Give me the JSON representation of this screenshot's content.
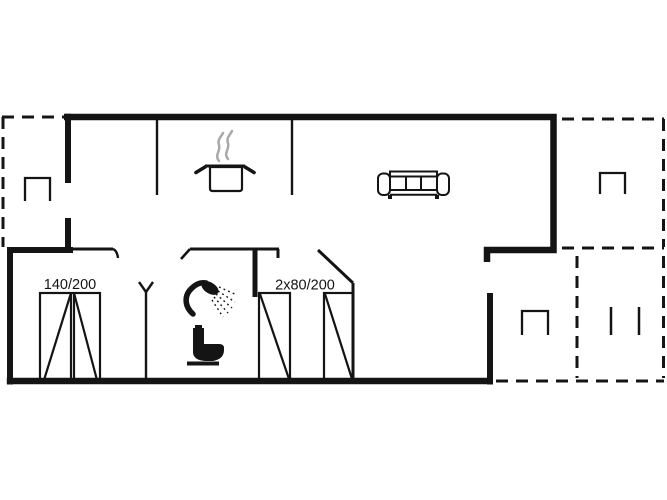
{
  "floor_plan": {
    "colors": {
      "line": "#141414",
      "steam": "#a9a9a9",
      "background": "#ffffff"
    },
    "labels": {
      "double_bed": "140/200",
      "twin_beds": "2x80/200"
    },
    "icons": {
      "kitchen": "cooking-pot-icon",
      "living_room": "sofa-icon",
      "bathroom": [
        "shower-icon",
        "toilet-icon"
      ],
      "hall": "coat-rack-icon",
      "terrace_left": "chair-icon",
      "terrace_right_upper": "chair-icon",
      "terrace_right_lower": [
        "chair-icon",
        "bench-icon"
      ]
    }
  }
}
